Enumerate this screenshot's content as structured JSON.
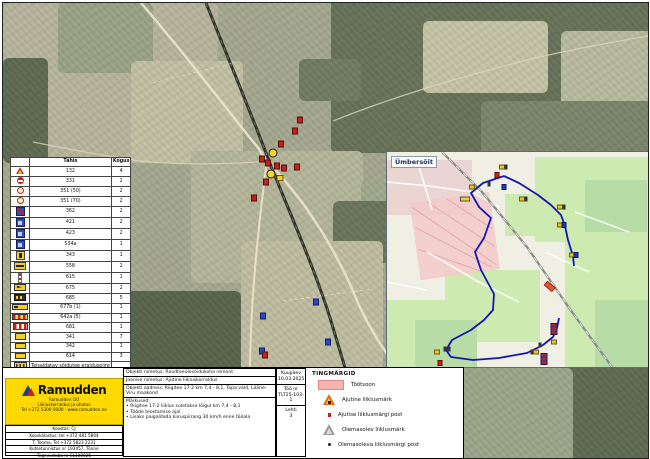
{
  "accent_colors": {
    "ramudden_yellow": "#ffd900",
    "route_blue": "#1414b4",
    "work_zone_pink": "#f5b4ae",
    "temp_sign_orange": "#e8680e"
  },
  "legend_table": {
    "headers": {
      "symbol_col": "Tähis",
      "qty_col": "Kogus"
    },
    "rows": [
      {
        "icon": "ic-tri",
        "code": "132",
        "qty": "4",
        "sep": false
      },
      {
        "icon": "ic-noentry",
        "code": "331",
        "qty": "2",
        "sep": false
      },
      {
        "icon": "ic-s50",
        "code": "351 (50)",
        "qty": "2",
        "sep": false
      },
      {
        "icon": "ic-s70",
        "code": "351 (70)",
        "qty": "2",
        "sep": false
      },
      {
        "icon": "ic-bluered",
        "code": "362",
        "qty": "2",
        "sep": true
      },
      {
        "icon": "ic-blue",
        "code": "421",
        "qty": "2",
        "sep": false
      },
      {
        "icon": "ic-blue",
        "code": "423",
        "qty": "2",
        "sep": false
      },
      {
        "icon": "ic-blue",
        "code": "534a",
        "qty": "1",
        "sep": false
      },
      {
        "icon": "ic-yplate",
        "code": "343",
        "qty": "1",
        "sep": true
      },
      {
        "icon": "ic-ytable",
        "code": "558",
        "qty": "2",
        "sep": false
      },
      {
        "icon": "ic-post",
        "code": "615",
        "qty": "1",
        "sep": false
      },
      {
        "icon": "ic-arrow",
        "code": "675",
        "qty": "2",
        "sep": false
      },
      {
        "icon": "ic-dark",
        "code": "685",
        "qty": "5",
        "sep": false
      },
      {
        "icon": "ic-wide",
        "code": "677b (1)",
        "qty": "1",
        "sep": true
      },
      {
        "icon": "ic-striped",
        "code": "642a (5)",
        "qty": "1",
        "sep": false
      },
      {
        "icon": "ic-fence",
        "code": "681",
        "qty": "1",
        "sep": false
      },
      {
        "icon": "ic-ysmall",
        "code": "341",
        "qty": "7",
        "sep": true
      },
      {
        "icon": "ic-ysmall",
        "code": "342",
        "qty": "1",
        "sep": false
      },
      {
        "icon": "ic-ysmall",
        "code": "614",
        "qty": "3",
        "sep": false
      },
      {
        "icon": "ic-block",
        "code": "Teisaldatav sõidutee eralduspiire",
        "qty": "",
        "sep": true
      },
      {
        "icon": "ic-flagred",
        "code": "Post 1,5 m",
        "qty": "23",
        "sep": false
      },
      {
        "icon": "ic-flagblue",
        "code": "Post 2 m",
        "qty": "1",
        "sep": true
      },
      {
        "icon": "ic-cross",
        "code": "Piloonid",
        "qty": "3",
        "sep": false
      }
    ]
  },
  "inset": {
    "label": "Ümbersõit",
    "markers": [
      {
        "x": 115,
        "y": 15,
        "k": "y"
      },
      {
        "x": 119,
        "y": 15,
        "k": "d"
      },
      {
        "x": 110,
        "y": 23,
        "k": "r"
      },
      {
        "x": 102,
        "y": 32,
        "k": "d"
      },
      {
        "x": 85,
        "y": 35,
        "k": "y"
      },
      {
        "x": 78,
        "y": 47,
        "k": "Y"
      },
      {
        "x": 117,
        "y": 35,
        "k": "b"
      },
      {
        "x": 135,
        "y": 47,
        "k": "y"
      },
      {
        "x": 139,
        "y": 47,
        "k": "d"
      },
      {
        "x": 173,
        "y": 55,
        "k": "y"
      },
      {
        "x": 177,
        "y": 55,
        "k": "d"
      },
      {
        "x": 173,
        "y": 73,
        "k": "y"
      },
      {
        "x": 177,
        "y": 73,
        "k": "b"
      },
      {
        "x": 185,
        "y": 103,
        "k": "y"
      },
      {
        "x": 189,
        "y": 103,
        "k": "b"
      },
      {
        "x": 167,
        "y": 177,
        "k": "R"
      },
      {
        "x": 167,
        "y": 190,
        "k": "y"
      },
      {
        "x": 153,
        "y": 193,
        "k": "d"
      },
      {
        "x": 145,
        "y": 200,
        "k": "d"
      },
      {
        "x": 149,
        "y": 200,
        "k": "y"
      },
      {
        "x": 62,
        "y": 197,
        "k": "d"
      },
      {
        "x": 58,
        "y": 197,
        "k": "d"
      },
      {
        "x": 50,
        "y": 200,
        "k": "y"
      },
      {
        "x": 53,
        "y": 211,
        "k": "r"
      },
      {
        "x": 157,
        "y": 207,
        "k": "R"
      }
    ]
  },
  "map": {
    "markers": [
      {
        "x": 299,
        "y": 119,
        "k": "r"
      },
      {
        "x": 294,
        "y": 130,
        "k": "r"
      },
      {
        "x": 280,
        "y": 143,
        "k": "r"
      },
      {
        "x": 272,
        "y": 152,
        "k": "yc"
      },
      {
        "x": 261,
        "y": 158,
        "k": "r"
      },
      {
        "x": 267,
        "y": 162,
        "k": "r"
      },
      {
        "x": 276,
        "y": 165,
        "k": "r"
      },
      {
        "x": 283,
        "y": 167,
        "k": "r"
      },
      {
        "x": 296,
        "y": 166,
        "k": "r"
      },
      {
        "x": 270,
        "y": 173,
        "k": "yc"
      },
      {
        "x": 279,
        "y": 177,
        "k": "y"
      },
      {
        "x": 265,
        "y": 181,
        "k": "r"
      },
      {
        "x": 253,
        "y": 197,
        "k": "r"
      },
      {
        "x": 262,
        "y": 315,
        "k": "b"
      },
      {
        "x": 315,
        "y": 301,
        "k": "b"
      },
      {
        "x": 327,
        "y": 341,
        "k": "b"
      },
      {
        "x": 261,
        "y": 350,
        "k": "b"
      },
      {
        "x": 264,
        "y": 354,
        "k": "r"
      }
    ]
  },
  "tingmargid": {
    "title": "TINGMÄRGID",
    "items": [
      {
        "icon": "tic-zone",
        "label": "Töötsoon"
      },
      {
        "icon": "tic-warn",
        "label": "Ajutine liiklusmärk"
      },
      {
        "icon": "tic-dotr",
        "label": "Ajutise liiklusmärgi post"
      },
      {
        "icon": "tic-warng",
        "label": "Olemasolev liiklusmärk"
      },
      {
        "icon": "tic-dotk",
        "label": "Olemasoleva liiklusmärgi post"
      }
    ]
  },
  "titleblock": {
    "logo_word": "Ramudden",
    "logo_sub": [
      "Ramudden OÜ",
      "Liikluskorraldus ja ohutus",
      "Tel +372 5300 0000 · www.ramudden.ee"
    ],
    "contact_rows": [
      "Koostas: CJ",
      "Kooskõlastus: tel +372 481 5804",
      "T. Toome, Tel +372 5823 2231",
      "Kutsetunnistus nr 193457, Tõnne",
      "Tegevusluba nr EL100025"
    ],
    "desc": {
      "object_name": "Objekti nimetus: Raudteeülesõidukoha remont",
      "drawing_name": "Joonise nimetus: Ajutine liikluskorraldus",
      "address": "Objekti aadress: Riigitee 17-2 km 7,4 - 8,1, Tapa vald, Lääne-Viru maakond",
      "notes_label": "Märkused:",
      "notes": [
        "Riigitee 17-2 liiklus suletakse lõigul km 7,4 - 8,1",
        "Tööde teostamise ajal",
        "Lisaks paigaldada kiiruspiirang 30 km/h enne tööala"
      ]
    },
    "fields_right": [
      {
        "label": "Kuupäev",
        "value": "10.03.2025"
      },
      {
        "label": "Töö nr",
        "value": "TLT25-103-1"
      },
      {
        "label": "Lehti",
        "value": "3"
      }
    ]
  }
}
